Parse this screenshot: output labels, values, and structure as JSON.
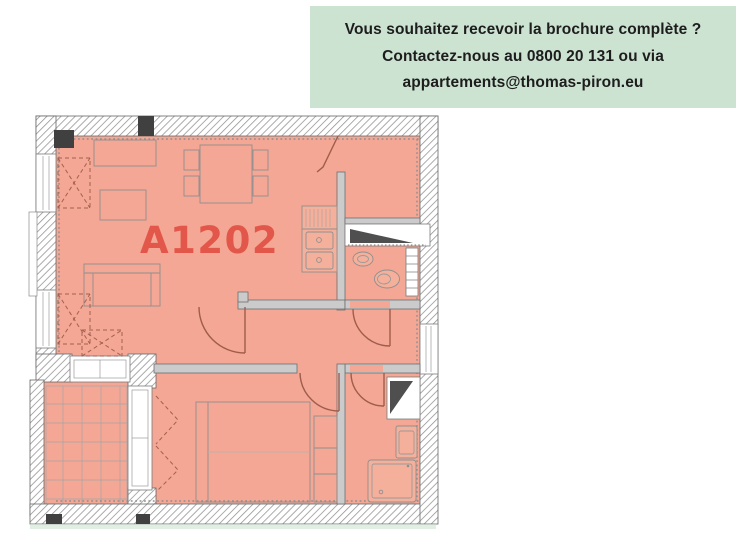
{
  "banner": {
    "lines": [
      "Vous souhaitez recevoir la brochure complète ?",
      "Contactez-nous au 0800 20 131 ou via",
      "appartements@thomas-piron.eu"
    ],
    "background_color": "#cde3d2",
    "text_color": "#1d1d1d"
  },
  "floor_plan": {
    "unit_label": "A1202",
    "unit_label_color": "#e2574a",
    "floor_color": "#f3a794",
    "fixture_fill": "#f5b09c",
    "wall_hatch_line_color": "#8f8f8f",
    "wall_dark_color": "#404040",
    "interior_wall_color": "#cbcbcb",
    "door_color": "#9f5d4b",
    "ground_strip_color": "#cde3d2"
  }
}
